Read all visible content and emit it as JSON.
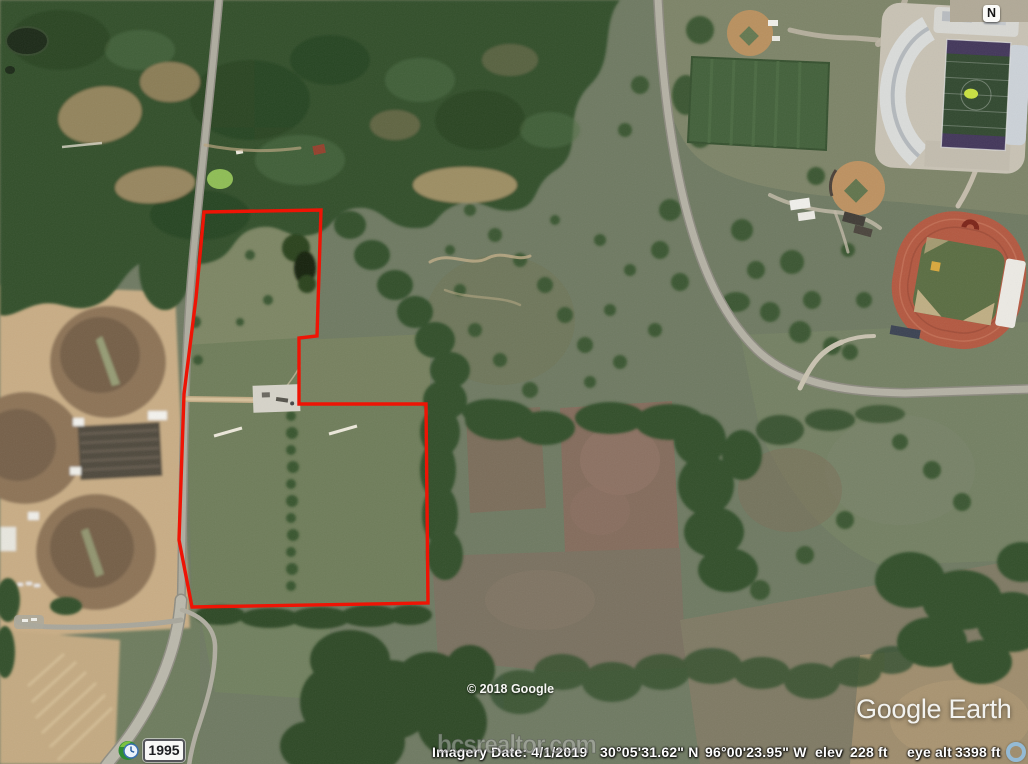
{
  "map_overlay": {
    "compass_label": "N",
    "road_shield_label": "1995",
    "copyright_text": "© 2018 Google",
    "logo_text": "Google Earth",
    "watermark_text": "bcsrealtor.com"
  },
  "status_bar": {
    "imagery_date": "Imagery Date: 4/1/2019",
    "latitude": "30°05'31.62\" N",
    "longitude": "96°00'23.95\" W",
    "elevation_label": "elev",
    "elevation_value": "228 ft",
    "eye_altitude_label": "eye alt",
    "eye_altitude_value": "3398 ft"
  },
  "colors": {
    "property_boundary": "#ee1405",
    "running_track": "#b35840",
    "forest": "#33502c",
    "dirt_fields": "#c9ad85",
    "status_text": "#ffffff",
    "progress_ring": "#94bedd"
  }
}
